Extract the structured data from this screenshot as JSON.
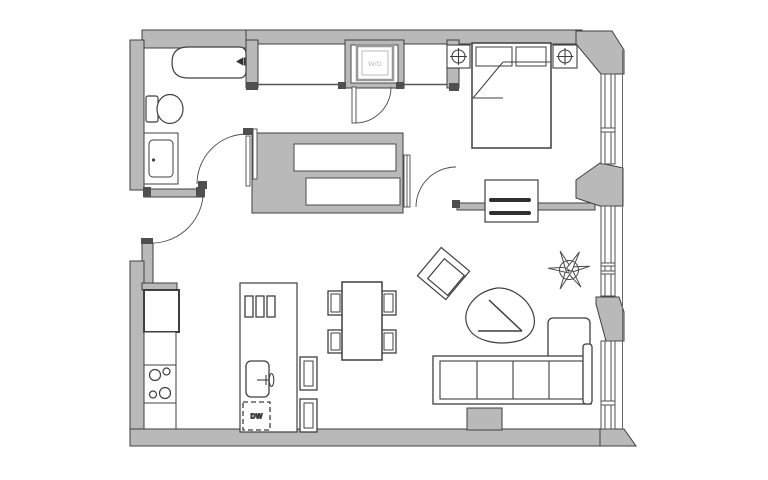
{
  "plan": {
    "type": "apartment floor plan",
    "labels": {
      "washer_dryer": "W/D",
      "dishwasher": "DW"
    },
    "colors": {
      "background": "#ffffff",
      "wall_fill": "#b9b9b9",
      "wall_edge": "#3f3f3f",
      "furniture_line": "#4a4a4a",
      "cap_dark": "#4f4f4f",
      "appliance_dark": "#2f2f2f",
      "label_light": "#b5b5b5",
      "label_dark": "#3d3d3d"
    }
  }
}
